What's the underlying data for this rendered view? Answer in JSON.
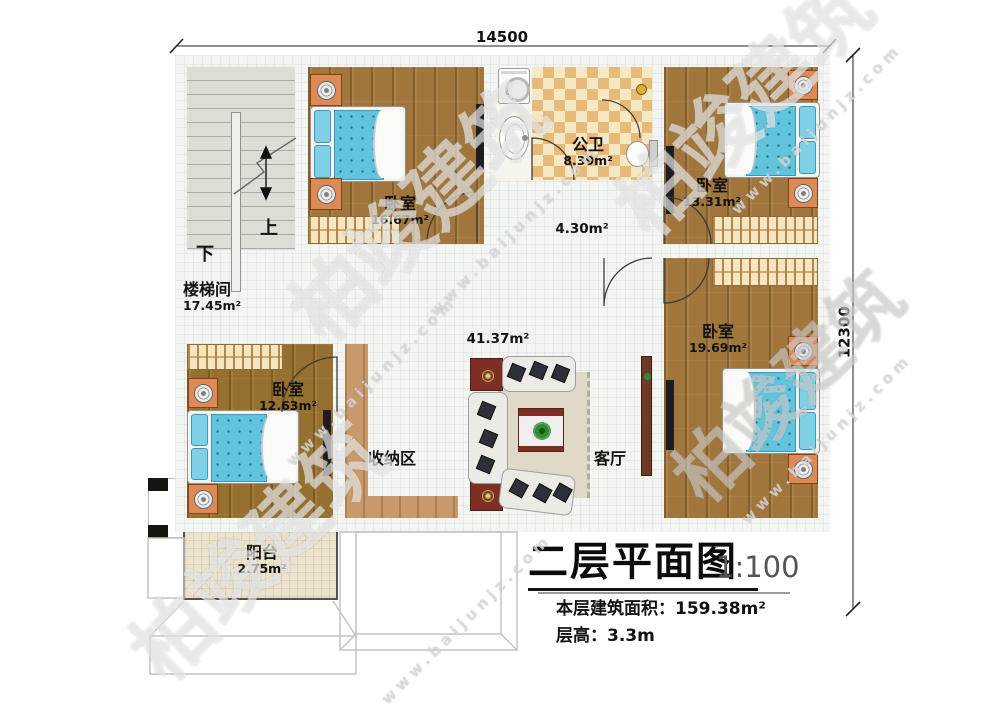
{
  "dimensions": {
    "width_mm": "14500",
    "height_mm": "12300"
  },
  "rooms": {
    "stairwell": {
      "name": "楼梯间",
      "area": "17.45m²"
    },
    "bedroom_top_left": {
      "name": "卧室",
      "area": "16.67m²"
    },
    "bathroom": {
      "name": "公卫",
      "area": "8.39m²"
    },
    "bedroom_top_right": {
      "name": "卧室",
      "area": "13.31m²"
    },
    "hallway": {
      "area": "4.30m²"
    },
    "living_area": {
      "area": "41.37m²"
    },
    "bedroom_right": {
      "name": "卧室",
      "area": "19.69m²"
    },
    "bedroom_bottom_left": {
      "name": "卧室",
      "area": "12.63m²"
    },
    "storage": {
      "name": "收纳区"
    },
    "living_room": {
      "name": "客厅"
    },
    "balcony": {
      "name": "阳台",
      "area": "2.75m²"
    }
  },
  "stairs": {
    "up_label": "上",
    "down_label": "下"
  },
  "title_block": {
    "title": "二层平面图",
    "scale": "1:100",
    "floor_area_label": "本层建筑面积：",
    "floor_area_value": "159.38m²",
    "floor_height_label": "层高：",
    "floor_height_value": "3.3m"
  },
  "watermark": {
    "brand": "柏竣建筑",
    "url": "www.baijunjz.com"
  },
  "colors": {
    "wall": "#17150f",
    "wood_floor": "#a0763c",
    "tile_light": "#f6e8c4",
    "tile_dark": "#e7bb77",
    "stair_floor": "#d9dfd5",
    "balcony_floor": "#ebe3cd",
    "bed_blue": "#62c4dc",
    "nightstand_orange": "#de8a54",
    "accent_dark_red": "#7d2f26"
  }
}
